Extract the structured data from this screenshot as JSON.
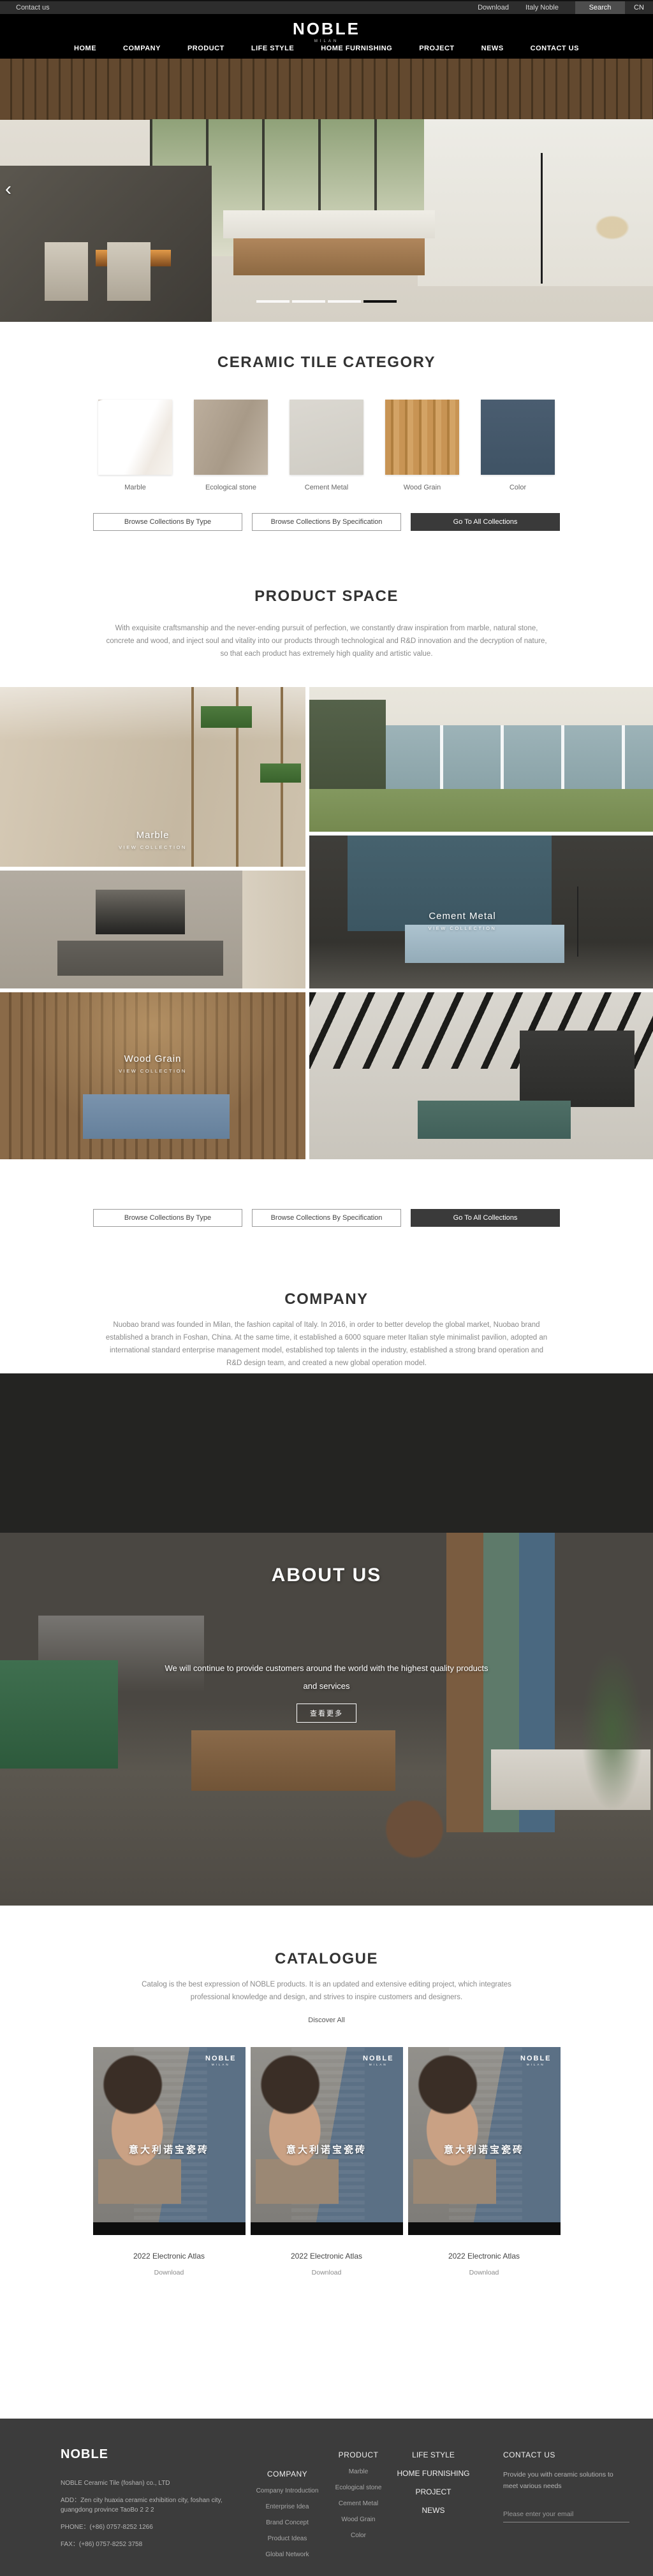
{
  "topbar": {
    "contact_us": "Contact us",
    "download": "Download",
    "italy_noble": "Italy Noble",
    "search": "Search",
    "language": "CN"
  },
  "header": {
    "logo": "NOBLE",
    "logo_subtitle": "MILAN",
    "nav": [
      {
        "label": "HOME"
      },
      {
        "label": "COMPANY"
      },
      {
        "label": "PRODUCT"
      },
      {
        "label": "LIFE STYLE"
      },
      {
        "label": "HOME FURNISHING"
      },
      {
        "label": "PROJECT"
      },
      {
        "label": "NEWS"
      },
      {
        "label": "CONTACT US"
      }
    ]
  },
  "hero": {
    "prev_arrow": "‹",
    "slides_total": 4,
    "active_slide": 4
  },
  "category": {
    "title": "CERAMIC TILE CATEGORY",
    "items": [
      {
        "label": "Marble",
        "color": "#f5f3f0"
      },
      {
        "label": "Ecological stone",
        "color": "#b0a391"
      },
      {
        "label": "Cement Metal",
        "color": "#d6d3cb"
      },
      {
        "label": "Wood Grain",
        "color": "#c4924f"
      },
      {
        "label": "Color",
        "color": "#46586a"
      }
    ],
    "buttons": [
      {
        "label": "Browse Collections By Type"
      },
      {
        "label": "Browse Collections By Specification"
      },
      {
        "label": "Go To All Collections"
      }
    ]
  },
  "product_space": {
    "title": "PRODUCT SPACE",
    "description": "With exquisite craftsmanship and the never-ending pursuit of perfection, we constantly draw inspiration from marble, natural stone, concrete and wood, and inject soul and vitality into our products through technological and R&D innovation and the decryption of nature, so that each product has extremely high quality and artistic value.",
    "tiles": [
      {
        "name": "Marble",
        "cta": "VIEW COLLECTION"
      },
      {
        "name": "Cement Metal",
        "cta": "VIEW COLLECTION"
      },
      {
        "name": "Wood Grain",
        "cta": "VIEW COLLECTION"
      }
    ],
    "buttons": [
      {
        "label": "Browse Collections By Type"
      },
      {
        "label": "Browse Collections By Specification"
      },
      {
        "label": "Go To All Collections"
      }
    ]
  },
  "company": {
    "title": "COMPANY",
    "description": "Nuobao brand was founded in Milan, the fashion capital of Italy. In 2016, in order to better develop the global market, Nuobao brand established a branch in Foshan, China. At the same time, it established a 6000 square meter Italian style minimalist pavilion, adopted an international standard enterprise management model, established top talents in the industry, established a strong brand operation and R&D design team, and created a new global operation model."
  },
  "about": {
    "title": "ABOUT US",
    "line1": "We will continue to provide customers around the world with the highest quality products",
    "line2": "and services",
    "more_button": "查看更多"
  },
  "catalogue": {
    "title": "CATALOGUE",
    "description": "Catalog is the best expression of NOBLE products. It is an updated and extensive editing project, which integrates professional knowledge and design, and strives to inspire customers and designers.",
    "discover_all": "Discover All",
    "cover_brand": "NOBLE",
    "cover_brand_sub": "MILAN",
    "cover_headline": "意大利诺宝瓷砖",
    "items": [
      {
        "title": "2022 Electronic Atlas",
        "download": "Download"
      },
      {
        "title": "2022 Electronic Atlas",
        "download": "Download"
      },
      {
        "title": "2022 Electronic Atlas",
        "download": "Download"
      }
    ]
  },
  "footer": {
    "logo": "NOBLE",
    "company_name": "NOBLE Ceramic Tile (foshan) co., LTD",
    "address": "ADD：Zen city huaxia ceramic exhibition city, foshan city, guangdong province TaoBo 2 2 2",
    "phone": "PHONE：(+86) 0757-8252 1266",
    "fax": "FAX：(+86) 0757-8252 3758",
    "columns": [
      {
        "title": "COMPANY",
        "links": [
          {
            "label": "Company Introduction"
          },
          {
            "label": "Enterprise Idea"
          },
          {
            "label": "Brand Concept"
          },
          {
            "label": "Product Ideas"
          },
          {
            "label": "Global Network"
          }
        ]
      },
      {
        "title": "PRODUCT",
        "links": [
          {
            "label": "Marble"
          },
          {
            "label": "Ecological stone"
          },
          {
            "label": "Cement Metal"
          },
          {
            "label": "Wood Grain"
          },
          {
            "label": "Color"
          }
        ]
      }
    ],
    "nav_links": [
      {
        "label": "LIFE STYLE"
      },
      {
        "label": "HOME FURNISHING"
      },
      {
        "label": "PROJECT"
      },
      {
        "label": "NEWS"
      }
    ],
    "contact": {
      "title": "CONTACT US",
      "text": "Provide you with ceramic solutions to meet various needs",
      "email_placeholder": "Please enter your email"
    }
  }
}
